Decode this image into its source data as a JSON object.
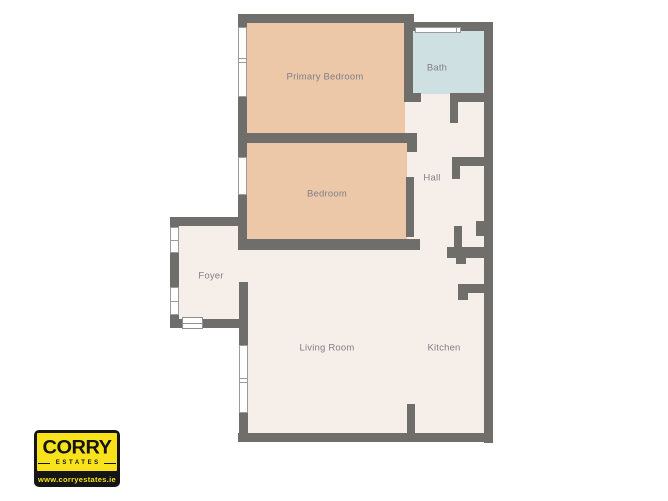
{
  "floorplan": {
    "rooms": [
      {
        "name": "Primary Bedroom"
      },
      {
        "name": "Bath"
      },
      {
        "name": "Bedroom"
      },
      {
        "name": "Hall"
      },
      {
        "name": "Foyer"
      },
      {
        "name": "Living Room"
      },
      {
        "name": "Kitchen"
      }
    ],
    "colors": {
      "wall": "#6f6e6b",
      "bedroom_fill": "#ecc8a9",
      "bath_fill": "#cfe0e2",
      "floor_fill": "#f6eee8",
      "label_text": "#7f808a",
      "background": "#ffffff"
    }
  },
  "logo": {
    "brand": "CORRY",
    "tagline": "ESTATES",
    "website": "www.corryestates.ie",
    "colors": {
      "yellow": "#f8e21c",
      "black": "#151515"
    }
  }
}
